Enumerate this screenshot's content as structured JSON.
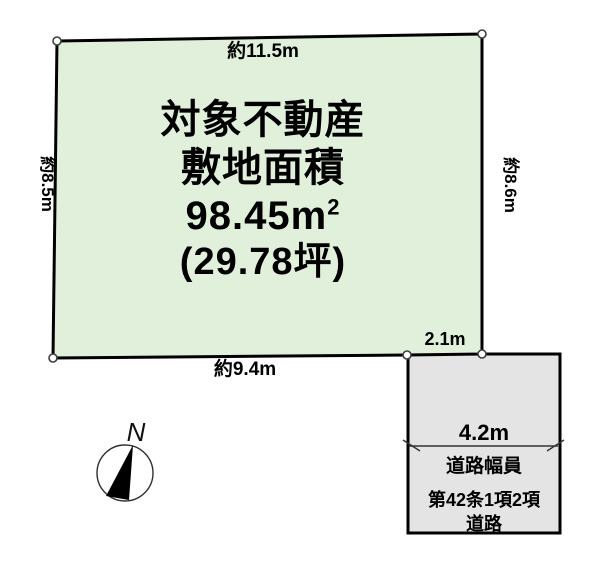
{
  "canvas": {
    "width": 600,
    "height": 581,
    "background": "#ffffff"
  },
  "parcel": {
    "label_line1": "対象不動産",
    "label_line2": "敷地面積",
    "area_main": "98.45m",
    "area_exponent": "2",
    "area_tsubo": "(29.78坪)",
    "fill_color": "#e1f0db",
    "border_color": "#000000"
  },
  "dimensions": {
    "top": "約11.5m",
    "left": "約8.5m",
    "right": "約8.6m",
    "bottom": "約9.4m",
    "frontage": "2.1m"
  },
  "road": {
    "width_label": "4.2m",
    "caption": "道路幅員",
    "designation_line1": "第42条1項2項",
    "designation_line2": "道路",
    "fill_color": "#e4e4e4",
    "border_color": "#000000"
  },
  "compass": {
    "north_label": "N"
  }
}
